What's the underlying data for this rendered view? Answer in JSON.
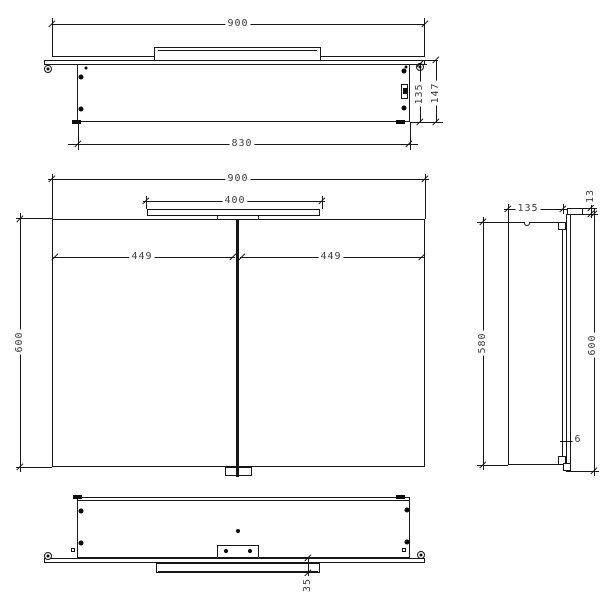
{
  "drawing": {
    "kind": "orthographic technical drawing",
    "subject": "mirror cabinet with top light fixture",
    "units": "mm"
  },
  "dims": {
    "top_width": "900",
    "top_body_width": "830",
    "top_depth": "135",
    "top_total_depth": "147",
    "front_width": "900",
    "front_light_width": "400",
    "front_door_left": "449",
    "front_door_right": "449",
    "front_height": "600",
    "side_depth": "135",
    "side_light_height": "13",
    "side_body_height": "580",
    "side_total_height": "600",
    "side_mirror_thickness": "6",
    "bottom_light_offset": "35"
  }
}
